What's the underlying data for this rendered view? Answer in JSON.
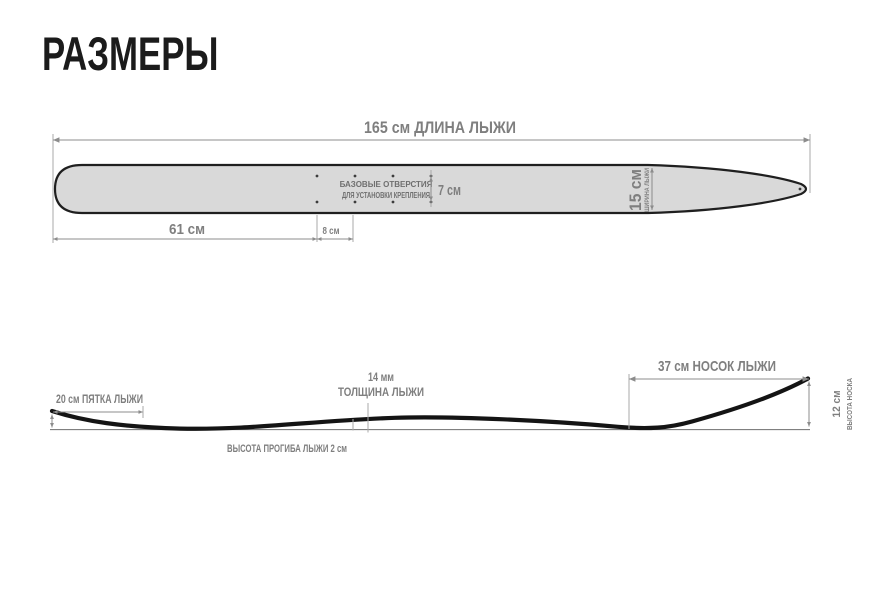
{
  "title": "РАЗМЕРЫ",
  "top_view": {
    "length": "165 см  ДЛИНА ЛЫЖИ",
    "tail_to_holes": "61 см",
    "hole_spacing": "8 см",
    "hole_rows_gap": "7 см",
    "width": "15 см",
    "width_caption": "ШИРИНА ЛЫЖИ",
    "holes_note_1": "БАЗОВЫЕ ОТВЕРСТИЯ",
    "holes_note_2": "ДЛЯ УСТАНОВКИ КРЕПЛЕНИЯ"
  },
  "side_view": {
    "tail": "20 см ПЯТКА ЛЫЖИ",
    "thickness_value": "14 мм",
    "thickness_caption": "ТОЛЩИНА ЛЫЖИ",
    "camber": "ВЫСОТА ПРОГИБА ЛЫЖИ  2 см",
    "nose": "37 см НОСОК ЛЫЖИ",
    "nose_height_value": "12 см",
    "nose_height_caption": "ВЫСОТА НОСКА"
  },
  "colors": {
    "label_gray": "#7f7f7f",
    "ski_fill": "#d9d9d9",
    "outline": "#1f1f1f",
    "dim_line": "#8c8c8c"
  }
}
